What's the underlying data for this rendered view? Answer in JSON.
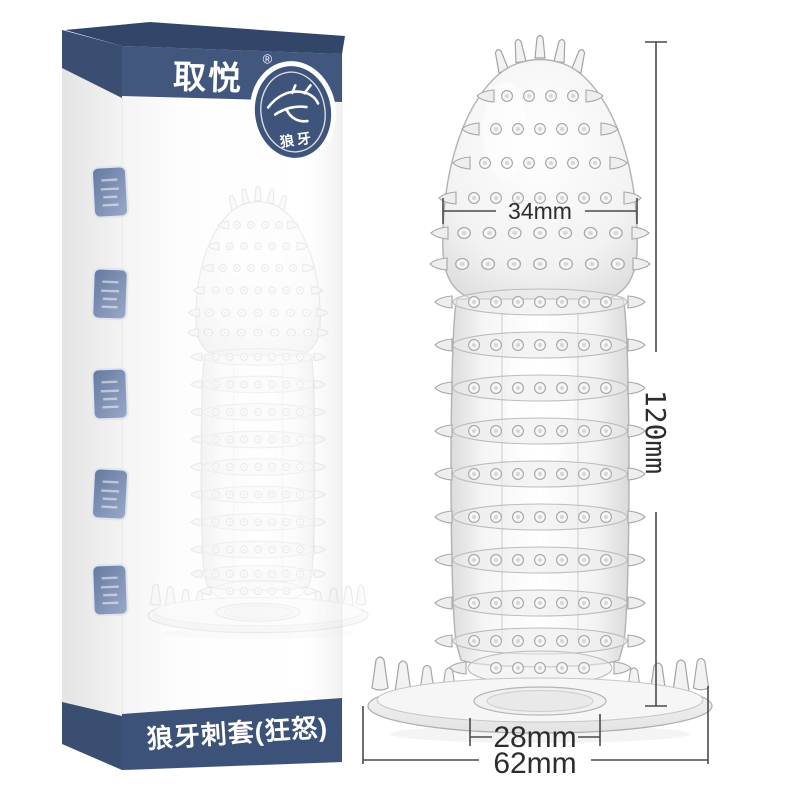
{
  "image_type": "e-commerce product photo",
  "box": {
    "brand": "取悦",
    "registered_mark": "®",
    "badge": {
      "icon": "wolf-icon",
      "label": "狼牙"
    },
    "product_name": "狼牙刺套(狂怒)",
    "seal_stamps": {
      "count": 5
    }
  },
  "product": {
    "visual": "transparent studded sleeve with spiked rows and flared spiked base"
  },
  "dimensions": {
    "head_width": "34mm",
    "total_length": "120mm",
    "inner_diameter": "28mm",
    "base_width": "62mm"
  },
  "colors": {
    "band_navy": "#42577d",
    "lid_navy": "#32466a",
    "side_navy": "#3a4e72",
    "bottom_band_navy": "#3d5278",
    "stamp_blue": "#64789f",
    "dimension_line": "#4a4a4a",
    "background": "#ffffff"
  }
}
